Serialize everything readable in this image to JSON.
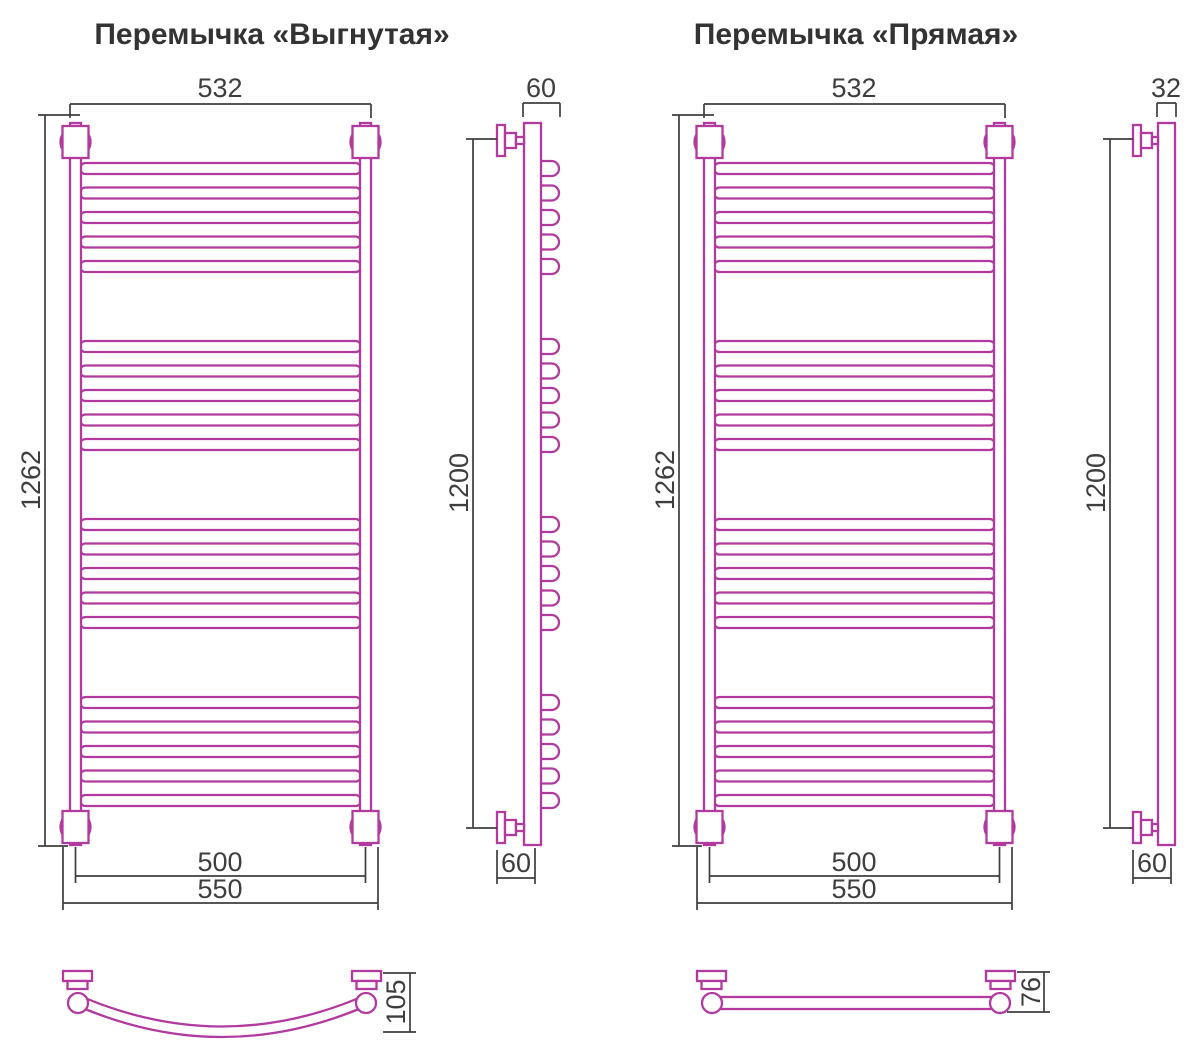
{
  "left": {
    "title": "Перемычка «Выгнутая»",
    "front": {
      "width": "532",
      "height": "1262",
      "mount_width": "500",
      "overall_width": "550"
    },
    "side": {
      "top_depth": "60",
      "height": "1200",
      "bottom_depth": "60"
    },
    "crossbar": {
      "depth": "105"
    },
    "structure": {
      "rung_groups": 4,
      "rungs_per_group": 5
    }
  },
  "right": {
    "title": "Перемычка «Прямая»",
    "front": {
      "width": "532",
      "height": "1262",
      "mount_width": "500",
      "overall_width": "550"
    },
    "side": {
      "top_depth": "32",
      "height": "1200",
      "bottom_depth": "60"
    },
    "crossbar": {
      "depth": "76"
    },
    "structure": {
      "rung_groups": 4,
      "rungs_per_group": 5
    }
  },
  "colors": {
    "line": "#b23a9e",
    "dimension": "#3e3e3e",
    "background": "#ffffff"
  }
}
